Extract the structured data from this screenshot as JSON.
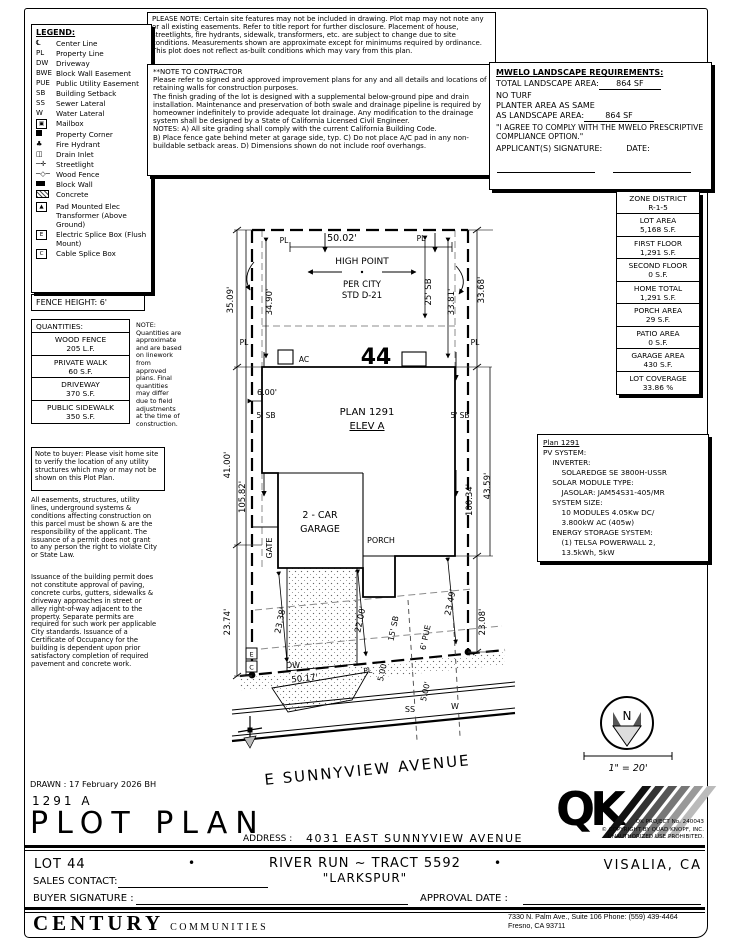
{
  "page": {
    "please_note": "PLEASE NOTE:  Certain site features may not be included in drawing.  Plot map may not note any or all existing easements. Refer to title report for further disclosure.  Placement of house, streetlights, fire hydrants, sidewalk, transformers, etc. are subject to change due to site conditions.  Measurements shown are approximate except for minimums required by ordinance.  This plot does not reflect as-built conditions which may vary from this plan.",
    "drawn_line": "DRAWN : 17 February 2026  BH"
  },
  "legend": {
    "title": "LEGEND:",
    "items": [
      {
        "symbol": "℄",
        "label": "Center Line"
      },
      {
        "symbol": "PL",
        "label": "Property Line"
      },
      {
        "symbol": "DW",
        "label": "Driveway"
      },
      {
        "symbol": "BWE",
        "label": "Block Wall Easement"
      },
      {
        "symbol": "PUE",
        "label": "Public Utility Easement"
      },
      {
        "symbol": "SB",
        "label": "Building Setback"
      },
      {
        "symbol": "SS",
        "label": "Sewer Lateral"
      },
      {
        "symbol": "W",
        "label": "Water Lateral"
      },
      {
        "icon": "mailbox",
        "label": "Mailbox"
      },
      {
        "icon": "property-corner",
        "label": "Property Corner"
      },
      {
        "icon": "fire-hydrant",
        "label": "Fire Hydrant"
      },
      {
        "icon": "drain-inlet",
        "label": "Drain Inlet"
      },
      {
        "icon": "streetlight",
        "label": "Streetlight"
      },
      {
        "icon": "wood-fence",
        "label": "Wood Fence"
      },
      {
        "icon": "block-wall",
        "label": "Block Wall"
      },
      {
        "icon": "concrete",
        "label": "Concrete"
      },
      {
        "icon": "transformer",
        "label": "Pad Mounted Elec Transformer (Above Ground)"
      },
      {
        "icon": "electric-splice",
        "label": "Electric Splice Box (Flush Mount)"
      },
      {
        "icon": "cable-splice",
        "label": "Cable Splice Box"
      }
    ]
  },
  "fence_height": "FENCE HEIGHT: 6'",
  "quantities": {
    "title": "QUANTITIES:",
    "rows": [
      {
        "name": "WOOD FENCE",
        "value": "205 L.F."
      },
      {
        "name": "PRIVATE WALK",
        "value": "60 S.F."
      },
      {
        "name": "DRIVEWAY",
        "value": "370 S.F."
      },
      {
        "name": "PUBLIC SIDEWALK",
        "value": "350 S.F."
      }
    ],
    "note": "NOTE:\nQuantities are approximate and are based on linework from approved plans.  Final quantities may differ due to field adjustments at the time of construction."
  },
  "buyer_note": "Note to buyer: Please visit home site to verify the location of any utility structures which may or may not be shown on this Plot Plan.",
  "legal_1": "All easements, structures, utility lines, underground systems & conditions affecting construction on this parcel must be shown & are the responsibility of the applicant. The issuance of a permit does not grant to any person the right to violate City or State Law.",
  "legal_2": "Issuance of the building permit does not constitute approval of paving, concrete curbs, gutters, sidewalks & driveway approaches in street or alley right-of-way adjacent to the property. Separate permits are required for such work per applicable City standards. Issuance of a Certificate of Occupancy for the building is dependent upon prior satisfactory completion of required pavement and concrete work.",
  "contractor_note": {
    "title": "**NOTE TO CONTRACTOR",
    "body": "Please refer to signed and approved improvement plans for any and all details and locations of retaining walls for construction purposes.\nThe finish grading of the lot is designed with a supplemental below-ground pipe and drain installation.  Maintenance and preservation of both swale and drainage pipeline is required by homeowner indefinitely to provide adequate lot drainage.  Any modification to the drainage system shall be designed by a State of California Licensed Civil Engineer.\nNOTES:  A) All site grading shall comply with the current California Building Code.\nB) Place fence gate behind meter at garage side, typ.  C) Do not place A/C pad in any non-buildable setback areas.  D) Dimensions shown do not include roof overhangs."
  },
  "mwelo": {
    "title": "MWELO LANDSCAPE REQUIREMENTS:",
    "total_label": "TOTAL LANDSCAPE AREA:",
    "total_value": "864 SF",
    "no_turf": "NO TURF",
    "planter_line1": "PLANTER AREA AS SAME",
    "planter_line2": "AS LANDSCAPE AREA:",
    "planter_value": "864 SF",
    "agreement": "\"I AGREE TO COMPLY WITH THE MWELO PRESCRIPTIVE COMPLIANCE OPTION.\"",
    "signature_label": "APPLICANT(S) SIGNATURE:",
    "date_label": "DATE:"
  },
  "zone_table": {
    "rows": [
      {
        "label": "ZONE DISTRICT",
        "value": "R-1-5"
      },
      {
        "label": "LOT AREA",
        "value": "5,168 S.F."
      },
      {
        "label": "FIRST FLOOR",
        "value": "1,291 S.F."
      },
      {
        "label": "SECOND FLOOR",
        "value": "0 S.F."
      },
      {
        "label": "HOME TOTAL",
        "value": "1,291 S.F."
      },
      {
        "label": "PORCH AREA",
        "value": "29 S.F."
      },
      {
        "label": "PATIO AREA",
        "value": "0 S.F."
      },
      {
        "label": "GARAGE AREA",
        "value": "430 S.F."
      },
      {
        "label": "LOT COVERAGE",
        "value": "33.86 %"
      }
    ]
  },
  "pv": {
    "title": "Plan 1291",
    "body": "PV SYSTEM:\n    INVERTER:\n        SOLAREDGE SE 3800H-USSR\n    SOLAR MODULE TYPE:\n        JASOLAR: JAM54S31-405/MR\n    SYSTEM SIZE:\n        10 MODULES 4.05Kw DC/\n        3.800kW AC (405w)\n    ENERGY STORAGE SYSTEM:\n        (1) TELSA POWERWALL 2,\n        13.5kWh, 5kW"
  },
  "drawing": {
    "pl": "PL",
    "dim_top": "50.02'",
    "high_point_1": "HIGH POINT",
    "high_point_2": "PER CITY",
    "high_point_3": "STD D-21",
    "dim_left_rear": "35.09'",
    "dim_34_90": "34.90'",
    "sb_25": "25' SB",
    "dim_33_81": "33.81'",
    "dim_right_rear": "33.68'",
    "lot_number": "44",
    "ac": "AC",
    "dim_6_00": "6.00'",
    "sb_5_left": "5' SB",
    "sb_5_right": "5' SB",
    "plan_label": "PLAN 1291",
    "elev_label": "ELEV A",
    "dim_41_00": "41.00'",
    "dim_105_82": "105.82'",
    "garage_1": "2 - CAR",
    "garage_2": "GARAGE",
    "porch": "PORCH",
    "gate": "GATE",
    "dim_100_34": "100.34'",
    "dim_43_59": "43.59'",
    "dim_23_74": "23.74'",
    "dim_23_38": "23.38'",
    "dim_22_00": "22.00'",
    "sb_15": "15' SB",
    "pue_6": "6' PUE",
    "dim_23_49": "23.49'",
    "dim_23_08": "23.08'",
    "splice_e": "E",
    "splice_c": "C",
    "dw": "DW",
    "dim_50_17": "50.17'",
    "dim_5_00_a": "5.00'",
    "dim_5_00_b": "5.00'",
    "ss": "SS",
    "w": "W",
    "street_name": "E SUNNYVIEW AVENUE"
  },
  "compass_n": "N",
  "scale_text": "1\" = 20'",
  "qk": {
    "logo": "QK",
    "project": "QK PROJECT No. 240043",
    "copyright": "© COPYRIGHT BY QUAD KNOPF, INC.",
    "prohibited": "UNAUTHORIZED USE PROHIBITED."
  },
  "titleblock": {
    "plan_elev": "1291   A",
    "title": "PLOT PLAN",
    "address_label": "ADDRESS :",
    "address": "4031 EAST SUNNYVIEW AVENUE",
    "lot": "LOT 44",
    "bullet": "•",
    "tract": "RIVER RUN ~ TRACT 5592",
    "community": "\"LARKSPUR\"",
    "city": "VISALIA, CA",
    "sales_contact": "SALES CONTACT:",
    "buyer_signature": "BUYER SIGNATURE :",
    "approval_date": "APPROVAL DATE :",
    "builder_main": "CENTURY",
    "builder_sub": "COMMUNITIES",
    "office1": "7330 N. Palm Ave., Suite 106    Phone: (559) 439-4464",
    "office2": "Fresno, CA  93711"
  }
}
